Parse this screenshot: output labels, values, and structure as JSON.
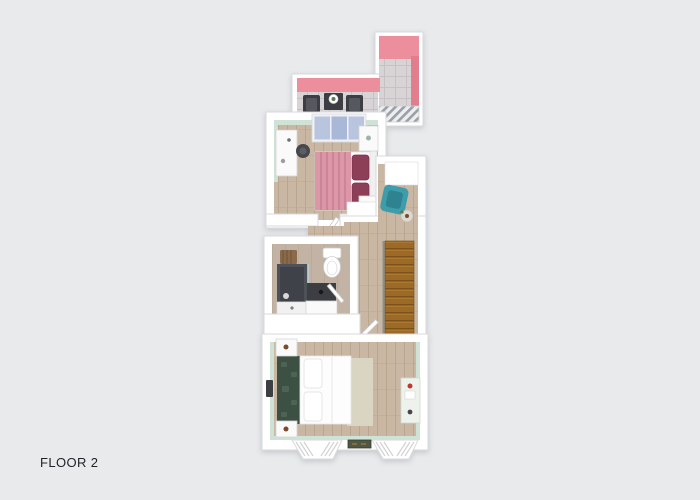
{
  "window": {
    "width": 700,
    "height": 500
  },
  "label": {
    "floor": "FLOOR 2"
  },
  "palette": {
    "bg": "#e8eaec",
    "text": "#1f2228",
    "wall": "#ffffff",
    "wall_stroke": "#d9dadc",
    "mint": "#cfe2d6",
    "pink_wall": "#ec8e9c",
    "pink_wall_dark": "#e27d8d",
    "tile": "#d8d4d6",
    "tile_line": "#c6c1c5",
    "wood": "#c9b7a3",
    "wood_line": "#b9a68e",
    "bath_floor": "#c2b3a5",
    "bath_line": "#b5a595",
    "stairs": "#9c6a26",
    "stairs_line": "#7a5118",
    "stairs_light": "#b5813a",
    "railing": "#9aa0a6",
    "railing_light": "#eceef0",
    "dark_furniture": "#3c3e43",
    "dark_furniture2": "#55585f",
    "white_furniture": "#fafafa",
    "furn_stroke": "#d5d5d5",
    "teal": "#3e9dab",
    "teal_dark": "#2f8290",
    "blanket_pink": "#db97a7",
    "blanket_stripe": "#c97f93",
    "pillow_maroon": "#8d3f58",
    "headboard_green": "#3d5044",
    "headboard_green2": "#4e6355",
    "rug_beige": "#d9d5c2",
    "doormat_green": "#4f5844",
    "basket_brown": "#8a6a4a",
    "window_blue": "#b9c5de",
    "window_blue2": "#a9b8d6",
    "knob_brown": "#7a4a2a",
    "red_accent": "#c0392b",
    "plant_green": "#5c7a52"
  },
  "plan": {
    "type": "3d-floorplan-render",
    "floor_label": "FLOOR 2",
    "rooms": [
      "balcony-terrace",
      "bedroom-1",
      "hallway-landing",
      "bathroom",
      "bedroom-2"
    ],
    "elements": [
      "patio-table",
      "patio-chairs",
      "terrace-railing",
      "sliding-window",
      "desk",
      "desk-chair",
      "double-bed-pink",
      "maroon-pillows",
      "nightstands",
      "wardrobe-closet",
      "armchair-teal",
      "floor-plant",
      "staircase",
      "toilet",
      "shower",
      "vanity-sink",
      "laundry-basket",
      "double-bed-white",
      "green-headboard",
      "bed-rug",
      "side-dresser",
      "wall-sconce",
      "bay-windows",
      "doormat"
    ]
  }
}
